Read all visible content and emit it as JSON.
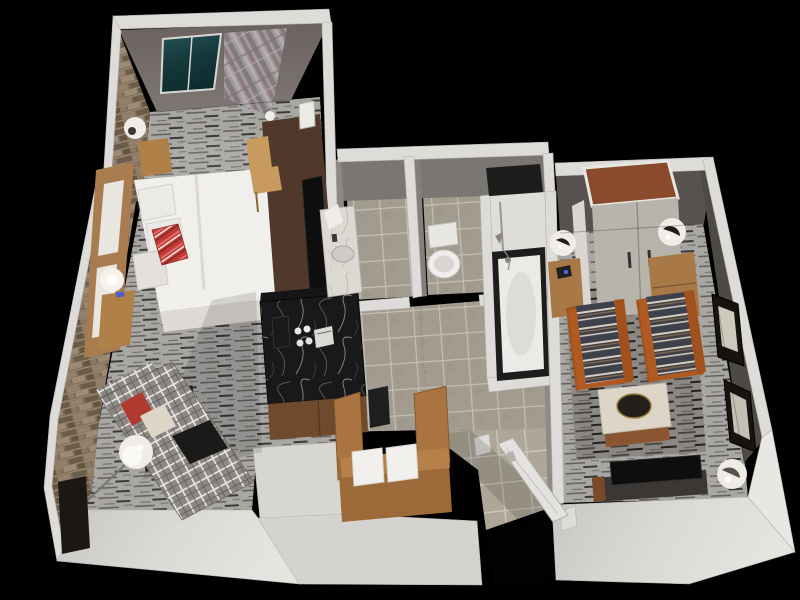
{
  "scene": {
    "kind": "3d-floorplan-render",
    "description": "Isometric 3D cutaway floor plan of a one-bedroom hotel suite on a black background",
    "background": "#000000"
  },
  "palette": {
    "background": "#000000",
    "wall_cap": "#dedcd8",
    "wall_outer_light": "#e9e7e3",
    "wall_face_south": "#d7d5d1",
    "wall_face_gray": "#7a7672",
    "wall_face_bedroom": "#6f6763",
    "wall_face_living": "#57524f",
    "wall_face_living_side": "#4d4946",
    "partition_gray": "#8c8985",
    "brick_base": "#7b6a57",
    "carpet_base": "#a9a7a4",
    "carpet_dark": "#8b8884",
    "tile_base": "#a29c90",
    "tile_entry": "#aea798",
    "glass_teal": "#1c4347",
    "curtain_gray": "#a09a9c",
    "marble_black": "#19191b",
    "marble_white": "#dcd9d3",
    "wood_light": "#c89a5f",
    "wood_oak": "#b08049",
    "wood_mid": "#a9743f",
    "wood_dark": "#50392a",
    "wood_cabinet": "#6f4a2c",
    "rust_orange": "#b05a22",
    "closet_top": "#8a4a2c",
    "stripe_dark": "#3e404b",
    "fabric_cream": "#ddd6c8",
    "accent_red": "#b03a30",
    "white_linen": "#f1efec",
    "lamp_white": "#f0ede8",
    "tv_black": "#0e0e0e"
  },
  "rooms": [
    {
      "id": "bedroom",
      "label": "Bedroom",
      "floor": "carpet"
    },
    {
      "id": "sitting-nook",
      "label": "Sitting area",
      "floor": "carpet"
    },
    {
      "id": "vanity-room",
      "label": "Vanity",
      "floor": "tile"
    },
    {
      "id": "toilet-room",
      "label": "Toilet",
      "floor": "tile"
    },
    {
      "id": "shower-room",
      "label": "Tub and shower",
      "floor": "tile"
    },
    {
      "id": "hallway",
      "label": "Hall / kitchenette",
      "floor": "tile"
    },
    {
      "id": "entry",
      "label": "Entry",
      "floor": "tile"
    },
    {
      "id": "living-room",
      "label": "Living room",
      "floor": "carpet"
    }
  ],
  "furniture": [
    {
      "name": "window with teal glazing",
      "room": "bedroom"
    },
    {
      "name": "plaid drapery panel",
      "room": "bedroom"
    },
    {
      "name": "king bed with white duvet",
      "room": "bedroom"
    },
    {
      "name": "red striped accent pillow",
      "room": "bedroom"
    },
    {
      "name": "wood headboard",
      "room": "bedroom"
    },
    {
      "name": "nightstand with globe lamp (x2)",
      "room": "bedroom"
    },
    {
      "name": "work desk with task chair",
      "room": "bedroom"
    },
    {
      "name": "flat-panel TV on credenza",
      "room": "bedroom"
    },
    {
      "name": "wall sconce",
      "room": "bedroom"
    },
    {
      "name": "plaid chaise lounge with pillows and tray",
      "room": "sitting-nook"
    },
    {
      "name": "orb floor lamp",
      "room": "sitting-nook"
    },
    {
      "name": "framed artwork on brick wall",
      "room": "sitting-nook"
    },
    {
      "name": "black marble coffee / minibar counter",
      "room": "hallway"
    },
    {
      "name": "coffee maker and cups",
      "room": "hallway"
    },
    {
      "name": "wood minibar cabinet",
      "room": "hallway"
    },
    {
      "name": "trash bin",
      "room": "hallway"
    },
    {
      "name": "marble vanity with sink",
      "room": "vanity-room"
    },
    {
      "name": "toilet",
      "room": "toilet-room"
    },
    {
      "name": "bathtub with shower fixtures",
      "room": "shower-room"
    },
    {
      "name": "built-in wood bench with two white pillows",
      "room": "entry"
    },
    {
      "name": "entry door (open)",
      "room": "entry"
    },
    {
      "name": "double-door wardrobe closet",
      "room": "living-room"
    },
    {
      "name": "side table with globe lamp (x2)",
      "room": "living-room"
    },
    {
      "name": "striped lounge armchair (x2)",
      "room": "living-room"
    },
    {
      "name": "upholstered ottoman with round tray",
      "room": "living-room"
    },
    {
      "name": "media console with TV",
      "room": "living-room"
    },
    {
      "name": "orb floor lamp",
      "room": "living-room"
    },
    {
      "name": "framed artwork pair on wall",
      "room": "living-room"
    },
    {
      "name": "area rug",
      "room": "living-room"
    }
  ]
}
